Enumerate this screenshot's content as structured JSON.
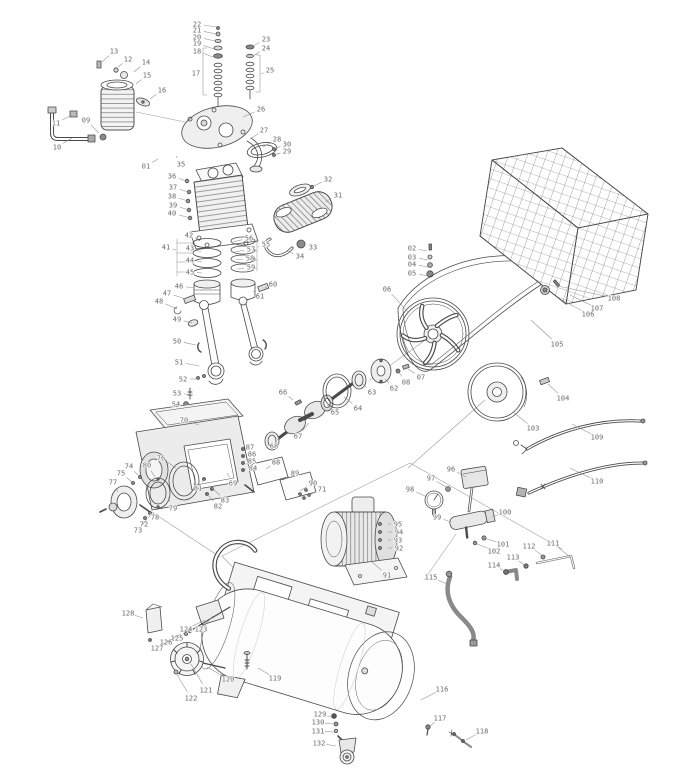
{
  "meta": {
    "background": "#ffffff",
    "line_color": "#4a4a4a",
    "label_color": "#6a6a6a",
    "leader_color": "#909090",
    "label_font_px": 7
  },
  "diagram": {
    "type": "exploded-parts-diagram",
    "subject": "belt-driven air compressor",
    "callout_count": 132
  },
  "callouts": [
    [
      "01",
      146,
      166,
      158,
      159
    ],
    [
      "02",
      412,
      248,
      427,
      251
    ],
    [
      "03",
      412,
      257,
      428,
      260
    ],
    [
      "04",
      412,
      264,
      428,
      267
    ],
    [
      "05",
      412,
      273,
      428,
      276
    ],
    [
      "06",
      387,
      289,
      408,
      312
    ],
    [
      "07",
      421,
      377,
      408,
      369
    ],
    [
      "08",
      406,
      382,
      398,
      371
    ],
    [
      "09",
      86,
      120,
      99,
      133
    ],
    [
      "10",
      57,
      147,
      72,
      138
    ],
    [
      "11",
      56,
      123,
      72,
      115
    ],
    [
      "12",
      128,
      59,
      118,
      67
    ],
    [
      "13",
      114,
      51,
      102,
      62
    ],
    [
      "14",
      146,
      62,
      134,
      72
    ],
    [
      "15",
      147,
      75,
      136,
      84
    ],
    [
      "16",
      162,
      90,
      150,
      99
    ],
    [
      "17",
      196,
      73,
      203,
      73
    ],
    [
      "18",
      197,
      51,
      213,
      57
    ],
    [
      "19",
      197,
      43,
      214,
      49
    ],
    [
      "20",
      197,
      37,
      215,
      41
    ],
    [
      "21",
      197,
      30,
      216,
      34
    ],
    [
      "22",
      197,
      24,
      216,
      27
    ],
    [
      "23",
      266,
      39,
      253,
      46
    ],
    [
      "24",
      266,
      48,
      253,
      56
    ],
    [
      "25",
      270,
      70,
      261,
      74
    ],
    [
      "26",
      261,
      109,
      243,
      117
    ],
    [
      "27",
      264,
      130,
      250,
      139
    ],
    [
      "28",
      277,
      139,
      263,
      147
    ],
    [
      "29",
      287,
      151,
      274,
      155
    ],
    [
      "30",
      287,
      144,
      274,
      149
    ],
    [
      "31",
      338,
      195,
      325,
      202
    ],
    [
      "32",
      328,
      179,
      312,
      187
    ],
    [
      "33",
      313,
      247,
      301,
      244
    ],
    [
      "34",
      300,
      256,
      286,
      251
    ],
    [
      "35",
      181,
      164,
      176,
      156
    ],
    [
      "36",
      172,
      176,
      186,
      181
    ],
    [
      "37",
      173,
      187,
      188,
      192
    ],
    [
      "38",
      172,
      196,
      188,
      201
    ],
    [
      "39",
      173,
      205,
      189,
      210
    ],
    [
      "40",
      172,
      213,
      190,
      218
    ],
    [
      "41",
      166,
      247,
      176,
      250
    ],
    [
      "42",
      189,
      235,
      200,
      241
    ],
    [
      "43",
      190,
      248,
      201,
      252
    ],
    [
      "44",
      190,
      260,
      202,
      262
    ],
    [
      "45",
      190,
      272,
      202,
      273
    ],
    [
      "46",
      179,
      286,
      195,
      288
    ],
    [
      "47",
      167,
      293,
      186,
      299
    ],
    [
      "48",
      159,
      301,
      177,
      309
    ],
    [
      "49",
      177,
      319,
      192,
      323
    ],
    [
      "50",
      177,
      341,
      196,
      345
    ],
    [
      "51",
      179,
      362,
      199,
      366
    ],
    [
      "52",
      183,
      379,
      199,
      379
    ],
    [
      "53",
      177,
      393,
      193,
      395
    ],
    [
      "54",
      176,
      404,
      191,
      405
    ],
    [
      "55",
      266,
      244,
      258,
      247
    ],
    [
      "56",
      249,
      238,
      233,
      242
    ],
    [
      "57",
      251,
      249,
      235,
      252
    ],
    [
      "58",
      250,
      258,
      236,
      260
    ],
    [
      "59",
      251,
      267,
      237,
      269
    ],
    [
      "60",
      273,
      284,
      265,
      288
    ],
    [
      "61",
      260,
      296,
      253,
      291
    ],
    [
      "62",
      394,
      388,
      385,
      379
    ],
    [
      "63",
      372,
      392,
      363,
      384
    ],
    [
      "64",
      358,
      408,
      344,
      397
    ],
    [
      "65",
      335,
      412,
      327,
      405
    ],
    [
      "66",
      283,
      392,
      293,
      400
    ],
    [
      "67",
      298,
      436,
      309,
      423
    ],
    [
      "68",
      274,
      446,
      279,
      437
    ],
    [
      "69",
      233,
      483,
      227,
      473
    ],
    [
      "70",
      184,
      420,
      199,
      425
    ],
    [
      "71",
      322,
      489,
      307,
      496
    ],
    [
      "72",
      144,
      524,
      151,
      514
    ],
    [
      "73",
      138,
      530,
      147,
      519
    ],
    [
      "74",
      129,
      466,
      139,
      476
    ],
    [
      "75",
      121,
      473,
      132,
      482
    ],
    [
      "76",
      161,
      458,
      176,
      468
    ],
    [
      "77",
      113,
      482,
      118,
      492
    ],
    [
      "78",
      155,
      517,
      158,
      506
    ],
    [
      "79",
      173,
      508,
      168,
      497
    ],
    [
      "80",
      147,
      465,
      155,
      477
    ],
    [
      "81",
      198,
      488,
      204,
      479
    ],
    [
      "82",
      218,
      506,
      207,
      494
    ],
    [
      "83",
      225,
      500,
      212,
      488
    ],
    [
      "84",
      253,
      468,
      245,
      469
    ],
    [
      "85",
      252,
      461,
      244,
      462
    ],
    [
      "86",
      252,
      454,
      244,
      455
    ],
    [
      "87",
      250,
      447,
      243,
      449
    ],
    [
      "88",
      276,
      462,
      266,
      469
    ],
    [
      "89",
      295,
      473,
      283,
      480
    ],
    [
      "90",
      313,
      483,
      300,
      491
    ],
    [
      "91",
      387,
      575,
      372,
      562
    ],
    [
      "92",
      399,
      548,
      388,
      548
    ],
    [
      "93",
      398,
      540,
      388,
      540
    ],
    [
      "94",
      399,
      532,
      388,
      532
    ],
    [
      "95",
      398,
      524,
      388,
      524
    ],
    [
      "96",
      451,
      469,
      466,
      477
    ],
    [
      "97",
      431,
      478,
      446,
      487
    ],
    [
      "98",
      410,
      489,
      427,
      497
    ],
    [
      "99",
      437,
      517,
      451,
      522
    ],
    [
      "100",
      505,
      512,
      492,
      517
    ],
    [
      "101",
      503,
      544,
      484,
      538
    ],
    [
      "102",
      494,
      551,
      475,
      543
    ],
    [
      "103",
      533,
      428,
      513,
      412
    ],
    [
      "104",
      563,
      398,
      548,
      384
    ],
    [
      "105",
      557,
      344,
      531,
      320
    ],
    [
      "106",
      588,
      314,
      562,
      300
    ],
    [
      "107",
      597,
      308,
      570,
      295
    ],
    [
      "108",
      614,
      298,
      558,
      286
    ],
    [
      "109",
      597,
      437,
      572,
      424
    ],
    [
      "110",
      597,
      481,
      570,
      468
    ],
    [
      "111",
      553,
      543,
      570,
      557
    ],
    [
      "112",
      529,
      546,
      543,
      556
    ],
    [
      "113",
      513,
      557,
      526,
      566
    ],
    [
      "114",
      494,
      565,
      508,
      573
    ],
    [
      "115",
      431,
      577,
      447,
      584
    ],
    [
      "116",
      442,
      689,
      421,
      700
    ],
    [
      "117",
      440,
      718,
      430,
      726
    ],
    [
      "118",
      482,
      731,
      466,
      740
    ],
    [
      "119",
      275,
      678,
      258,
      668
    ],
    [
      "120",
      228,
      679,
      207,
      667
    ],
    [
      "121",
      206,
      690,
      191,
      664
    ],
    [
      "122",
      191,
      698,
      176,
      673
    ],
    [
      "123",
      201,
      629,
      213,
      616
    ],
    [
      "124",
      186,
      629,
      205,
      620
    ],
    [
      "125",
      177,
      638,
      190,
      629
    ],
    [
      "126",
      166,
      642,
      181,
      634
    ],
    [
      "127",
      157,
      648,
      172,
      639
    ],
    [
      "128",
      128,
      613,
      143,
      618
    ],
    [
      "129",
      320,
      714,
      331,
      717
    ],
    [
      "130",
      318,
      722,
      333,
      724
    ],
    [
      "131",
      318,
      731,
      334,
      732
    ],
    [
      "132",
      319,
      743,
      336,
      746
    ]
  ]
}
